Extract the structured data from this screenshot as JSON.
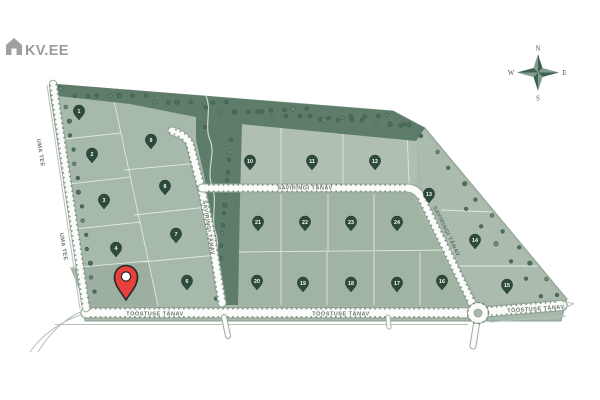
{
  "logo": {
    "text": "KV.EE",
    "icon": "house-icon"
  },
  "compass": {
    "north": "N",
    "south": "S",
    "east": "E",
    "west": "W"
  },
  "colors": {
    "plot_green": "#a6b9ab",
    "plot_green_light": "#b0bfb1",
    "plot_green_mid": "#a1b4a4",
    "tree_green": "#5d7c6a",
    "dot_green": "#4e6e5c",
    "road_white": "#fbfbf9",
    "road_edge": "#93a396",
    "marker_green": "#2d4a3a",
    "pin_red": "#e8403c",
    "logo_gray": "#9c9c9c",
    "compass_green": "#41604f"
  },
  "streets": [
    {
      "id": "uma-tee-upper",
      "name": "UMA TEE",
      "x": 39,
      "y": 153,
      "rotation": 81
    },
    {
      "id": "uma-tee-lower",
      "name": "UMA TEE",
      "x": 62,
      "y": 247,
      "rotation": 81
    },
    {
      "id": "saviringi-horizontal",
      "name": "SAVIRINGI TÄNAV",
      "x": 305,
      "y": 189.5,
      "rotation": 0
    },
    {
      "id": "saviringi-vertical",
      "name": "SAVIRINGI TÄNAV",
      "x": 207,
      "y": 228,
      "rotation": 81
    },
    {
      "id": "saviringi-diagonal",
      "name": "SAVIRINGI TÄNAV",
      "x": 445,
      "y": 232,
      "rotation": 64
    },
    {
      "id": "toostuse-left",
      "name": "TÖÖSTUSE TÄNAV",
      "x": 155,
      "y": 315.5,
      "rotation": 0
    },
    {
      "id": "toostuse-middle",
      "name": "TÖÖSTUSE TÄNAV",
      "x": 341,
      "y": 315.5,
      "rotation": 0
    },
    {
      "id": "toostuse-right",
      "name": "TÖÖSTUSE TÄNAV",
      "x": 536,
      "y": 310.5,
      "rotation": -4
    }
  ],
  "plots": [
    {
      "number": "1",
      "x": 79,
      "y": 111
    },
    {
      "number": "2",
      "x": 92,
      "y": 154
    },
    {
      "number": "3",
      "x": 104,
      "y": 200
    },
    {
      "number": "4",
      "x": 116,
      "y": 248
    },
    {
      "number": "6",
      "x": 187,
      "y": 281
    },
    {
      "number": "7",
      "x": 176,
      "y": 234
    },
    {
      "number": "8",
      "x": 165,
      "y": 186
    },
    {
      "number": "9",
      "x": 151,
      "y": 140
    },
    {
      "number": "10",
      "x": 250,
      "y": 161
    },
    {
      "number": "11",
      "x": 312,
      "y": 161
    },
    {
      "number": "12",
      "x": 375,
      "y": 161
    },
    {
      "number": "13",
      "x": 429,
      "y": 194
    },
    {
      "number": "14",
      "x": 475,
      "y": 240
    },
    {
      "number": "15",
      "x": 507,
      "y": 285
    },
    {
      "number": "16",
      "x": 442,
      "y": 281
    },
    {
      "number": "17",
      "x": 397,
      "y": 283
    },
    {
      "number": "18",
      "x": 351,
      "y": 283
    },
    {
      "number": "19",
      "x": 303,
      "y": 283
    },
    {
      "number": "20",
      "x": 257,
      "y": 281
    },
    {
      "number": "21",
      "x": 258,
      "y": 222
    },
    {
      "number": "22",
      "x": 305,
      "y": 222
    },
    {
      "number": "23",
      "x": 351,
      "y": 222
    },
    {
      "number": "24",
      "x": 397,
      "y": 222
    }
  ],
  "selected_plot": {
    "x": 126,
    "y": 277,
    "color": "#e8403c"
  }
}
